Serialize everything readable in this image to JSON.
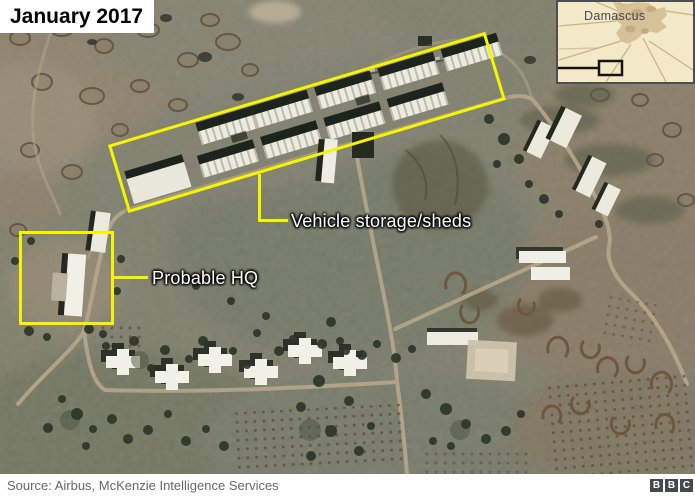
{
  "title": "January 2017",
  "inset": {
    "city_label": "Damascus"
  },
  "annotations": {
    "sheds_label": "Vehicle storage/sheds",
    "hq_label": "Probable HQ"
  },
  "footer": {
    "source": "Source: Airbus, McKenzie Intelligence Services",
    "logo_letters": [
      "B",
      "B",
      "C"
    ]
  },
  "colors": {
    "annotation_yellow": "#f6f500",
    "label_text": "#ffffff",
    "title_text": "#000000",
    "title_bg": "#ffffff",
    "inset_bg": "#f3e8c7",
    "inset_city_fill": "#d7c199",
    "inset_marker": "#141414",
    "footer_text": "#676767",
    "bbc_block_bg": "#48494b",
    "terrain_base": "#7c7d6b"
  }
}
